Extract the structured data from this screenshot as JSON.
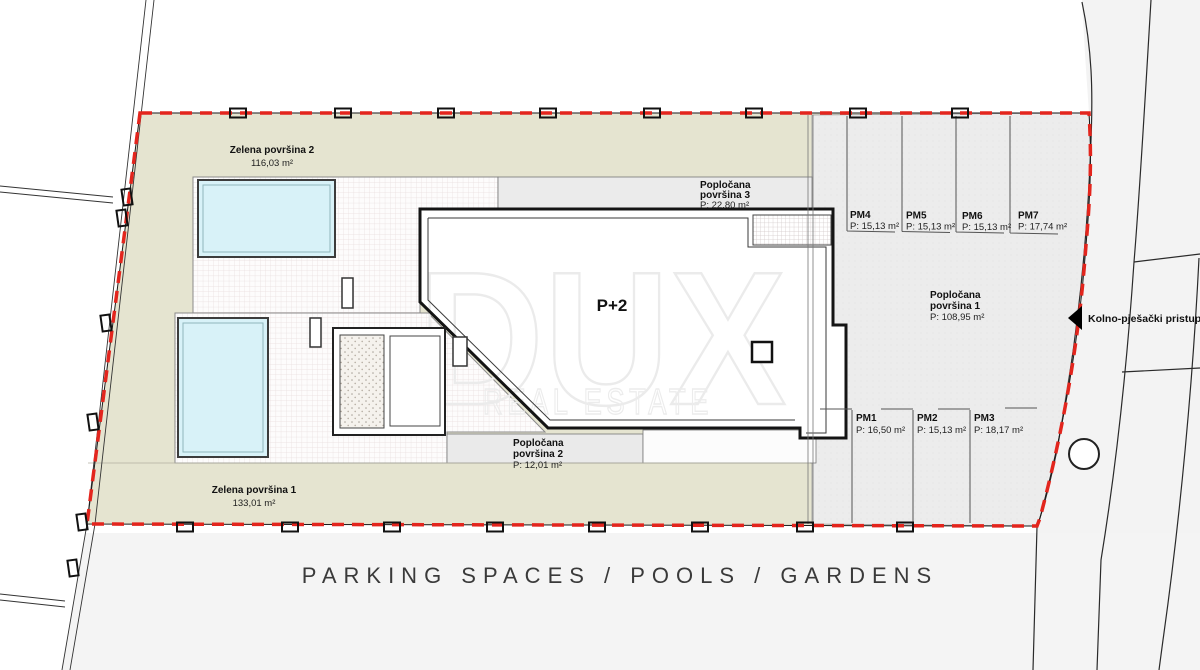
{
  "title": "PARKING SPACES / POOLS / GARDENS",
  "watermark": {
    "brand": "DUX",
    "sub": "REAL ESTATE"
  },
  "building": {
    "label": "P+2"
  },
  "access": {
    "label": "Kolno-pješački pristup"
  },
  "areas": {
    "zelena2": {
      "name": "Zelena površina 2",
      "area": "116,03 m²"
    },
    "zelena1": {
      "name": "Zelena površina 1",
      "area": "133,01 m²"
    },
    "poplocana1": {
      "name_line1": "Popločana",
      "name_line2": "površina 1",
      "area": "P: 108,95 m²"
    },
    "poplocana2": {
      "name_line1": "Popločana",
      "name_line2": "površina 2",
      "area": "P: 12,01 m²"
    },
    "poplocana3": {
      "name_line1": "Popločana",
      "name_line2": "površina 3",
      "area": "P: 22,80 m²"
    }
  },
  "parking": {
    "spaces": [
      {
        "id": "PM1",
        "area": "P: 16,50 m²"
      },
      {
        "id": "PM2",
        "area": "P: 15,13 m²"
      },
      {
        "id": "PM3",
        "area": "P: 18,17 m²"
      },
      {
        "id": "PM4",
        "area": "P: 15,13 m²"
      },
      {
        "id": "PM5",
        "area": "P: 15,13 m²"
      },
      {
        "id": "PM6",
        "area": "P: 15,13 m²"
      },
      {
        "id": "PM7",
        "area": "P: 17,74 m²"
      }
    ]
  },
  "colors": {
    "boundary": "#e3251d",
    "green": "#e5e4d0",
    "pool": "#d8f2f8",
    "parking": "#ececec"
  }
}
